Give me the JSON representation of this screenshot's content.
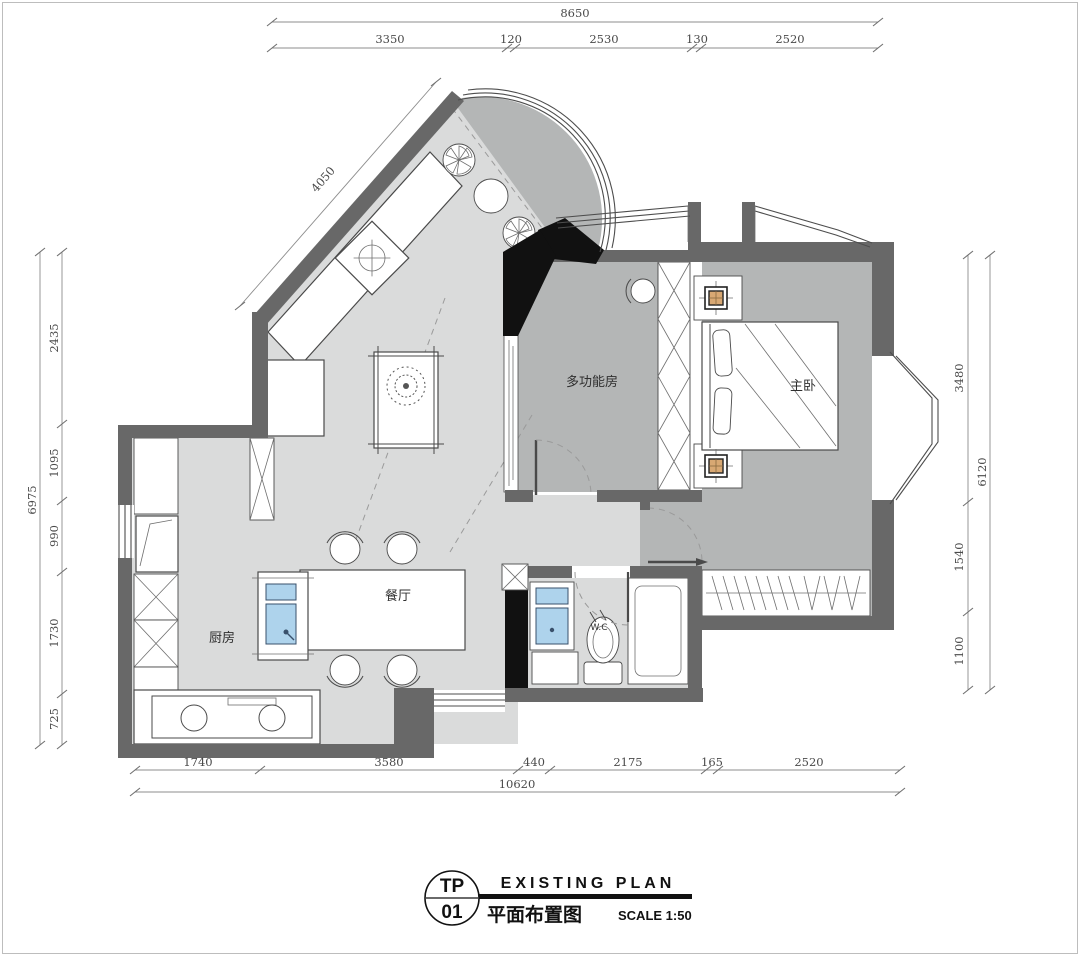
{
  "drawing": {
    "rooms": {
      "multi_function": "多功能房",
      "master_bedroom": "主卧",
      "dining": "餐厅",
      "kitchen": "厨房",
      "wc": "W.C"
    },
    "dimensions": {
      "top": {
        "total": "8650",
        "segments": [
          "3350",
          "120",
          "2530",
          "130",
          "2520"
        ]
      },
      "bottom": {
        "total": "10620",
        "segments": [
          "1740",
          "3580",
          "440",
          "2175",
          "165",
          "2520"
        ]
      },
      "left": {
        "total": "6975",
        "segments": [
          "2435",
          "1095",
          "990",
          "1730",
          "725"
        ]
      },
      "right": {
        "total": "6120",
        "segments": [
          "3480",
          "1540",
          "1100"
        ]
      },
      "diagonal": "4050"
    },
    "title_block": {
      "code_top": "TP",
      "code_no": "01",
      "name_en": "EXISTING PLAN",
      "name_zh": "平面布置图",
      "scale": "SCALE 1:50"
    },
    "colors": {
      "wall": "#686868",
      "wall_black": "#111111",
      "floor_light": "#dadbdb",
      "floor_medium": "#b4b6b6",
      "sink_blue": "#aed3ec",
      "lamp_tan": "#d8a873"
    }
  }
}
